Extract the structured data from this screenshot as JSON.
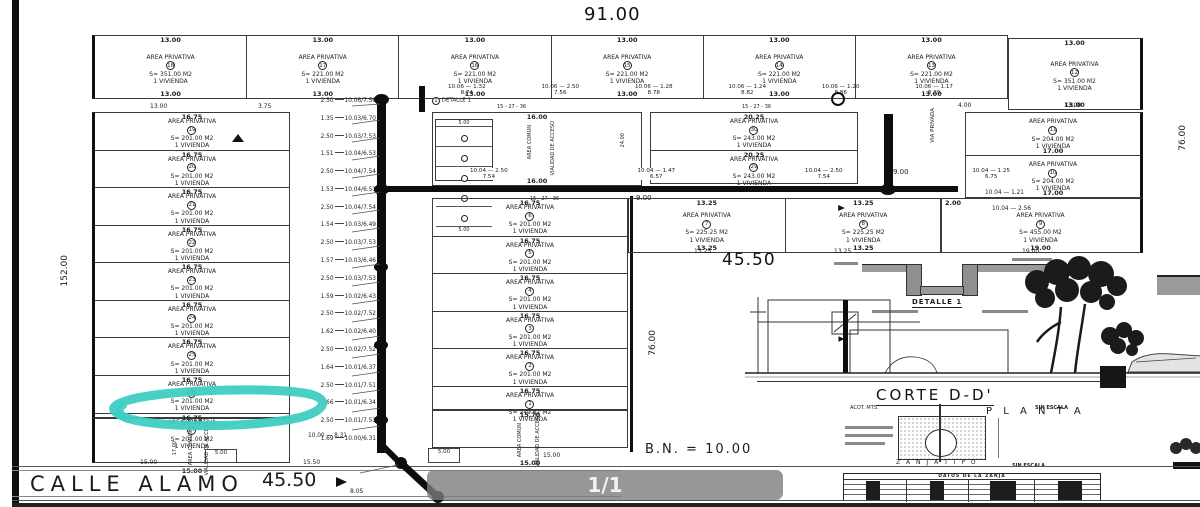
{
  "colors": {
    "highlight": "#3ECDC4",
    "ink": "#222222",
    "overlay_bg": "#7d7d7d"
  },
  "header": {
    "total_width": "91.00"
  },
  "side_dims": {
    "left_height": "152.00",
    "center_height": "76.00",
    "right_height": "76.00"
  },
  "lot_common": {
    "area_label": "AREA PRIVATIVA",
    "vivienda": "1 VIVIENDA"
  },
  "top_row": {
    "lots": [
      {
        "num": "18",
        "w": "13.00",
        "s": "S= 351.00 M2"
      },
      {
        "num": "17",
        "w": "13.00",
        "s": "S= 221.00 M2"
      },
      {
        "num": "16",
        "w": "13.00",
        "s": "S= 221.00 M2"
      },
      {
        "num": "15",
        "w": "13.00",
        "s": "S= 221.00 M2"
      },
      {
        "num": "14",
        "w": "13.00",
        "s": "S= 221.00 M2"
      },
      {
        "num": "13",
        "w": "13.00",
        "s": "S= 221.00 M2"
      }
    ],
    "corner": {
      "num": "12",
      "w": "13.00",
      "wb": "13.00",
      "s": "S= 351.00 M2"
    }
  },
  "left_col": {
    "sub_a": "13.00",
    "sub_b": "3.75",
    "lots": [
      {
        "num": "19",
        "w": "16.75",
        "s": "S= 201.00 M2"
      },
      {
        "num": "20",
        "w": "16.75",
        "s": "S= 201.00 M2"
      },
      {
        "num": "21",
        "w": "16.75",
        "s": "S= 201.00 M2"
      },
      {
        "num": "22",
        "w": "16.75",
        "s": "S= 201.00 M2"
      },
      {
        "num": "23",
        "w": "16.75",
        "s": "S= 201.00 M2"
      },
      {
        "num": "24",
        "w": "16.75",
        "s": "S= 201.00 M2"
      },
      {
        "num": "25",
        "w": "16.75",
        "s": "S= 201.00 M2"
      },
      {
        "num": "26",
        "w": "16.75",
        "s": "S= 201.00 M2"
      },
      {
        "num": "27",
        "w": "16.75",
        "s": "S= 201.00 M2"
      }
    ],
    "bottom_lot": {
      "w": "16.75",
      "wb": "15.00",
      "side": "17.00",
      "vtext": "VIALIDAD DE ACCESO",
      "vtext2": "AREA COMUN"
    }
  },
  "center_col": {
    "detail_lot": {
      "w": "16.00",
      "wb": "16.00",
      "cell_top": "5.00",
      "cell_bottom": "5.00",
      "side": "24.00",
      "vtext": "AREA COMUN",
      "vtext2": "VIALIDAD DE ACCESO"
    },
    "lots": [
      {
        "num": "6",
        "w": "16.75",
        "s": "S= 201.00 M2"
      },
      {
        "num": "5",
        "w": "16.75",
        "s": "S= 201.00 M2"
      },
      {
        "num": "4",
        "w": "16.75",
        "s": "S= 201.00 M2"
      },
      {
        "num": "3",
        "w": "16.75",
        "s": "S= 201.00 M2"
      },
      {
        "num": "2",
        "w": "16.75",
        "s": "S= 201.00 M2"
      },
      {
        "num": "1",
        "w": "16.75",
        "s": "S= 249.67 M2"
      }
    ],
    "bottom_lot": {
      "w": "15.70",
      "wb": "15.00",
      "vtext": "VIALIDAD DE ACCESO",
      "vtext2": "AREA COMUN"
    }
  },
  "pair_col": {
    "lots": [
      {
        "num": "30",
        "w": "20.25",
        "s": "S= 243.00 M2"
      },
      {
        "num": "29",
        "w": "20.25",
        "s": "S= 243.00 M2",
        "wb": "20.25"
      }
    ]
  },
  "row_13_25": {
    "lots": [
      {
        "num": "7",
        "w": "13.25",
        "wb": "13.25",
        "s": "S= 225.25 M2"
      },
      {
        "num": "8",
        "w": "13.25",
        "wb": "13.25",
        "s": "S= 225.25 M2"
      }
    ]
  },
  "right_col": {
    "lots": [
      {
        "num": "11",
        "wb": "17.00",
        "s": "S= 204.00 M2"
      },
      {
        "num": "10",
        "wb": "17.00",
        "s": "S= 204.00 M2"
      }
    ],
    "big_lot": {
      "num": "9",
      "wb": "19.00",
      "s": "S= 455.00 M2",
      "side": "2.00"
    },
    "via_privada": "VIA PRIVADA",
    "w4": "4.00",
    "w13": "13.00"
  },
  "leaders_left": [
    {
      "a": "2.50",
      "b": "10.06",
      "c": "7.56"
    },
    {
      "a": "1.35",
      "b": "10.03",
      "c": "6.70"
    },
    {
      "a": "2.50",
      "b": "10.03",
      "c": "7.53"
    },
    {
      "a": "1.51",
      "b": "10.04",
      "c": "6.53"
    },
    {
      "a": "2.50",
      "b": "10.04",
      "c": "7.54"
    },
    {
      "a": "1.53",
      "b": "10.04",
      "c": "6.51"
    },
    {
      "a": "2.50",
      "b": "10.04",
      "c": "7.54"
    },
    {
      "a": "1.54",
      "b": "10.03",
      "c": "6.49"
    },
    {
      "a": "2.50",
      "b": "10.03",
      "c": "7.53"
    },
    {
      "a": "1.57",
      "b": "10.03",
      "c": "6.46"
    },
    {
      "a": "2.50",
      "b": "10.03",
      "c": "7.53"
    },
    {
      "a": "1.59",
      "b": "10.02",
      "c": "6.43"
    },
    {
      "a": "2.50",
      "b": "10.02",
      "c": "7.52"
    },
    {
      "a": "1.62",
      "b": "10.02",
      "c": "6.40"
    },
    {
      "a": "2.50",
      "b": "10.02",
      "c": "7.52"
    },
    {
      "a": "1.64",
      "b": "10.01",
      "c": "6.37"
    },
    {
      "a": "2.50",
      "b": "10.01",
      "c": "7.51"
    },
    {
      "a": "1.66",
      "b": "10.01",
      "c": "6.34"
    },
    {
      "a": "2.50",
      "b": "10.01",
      "c": "7.51"
    },
    {
      "a": "1.69",
      "b": "10.00",
      "c": "6.31"
    }
  ],
  "leaders_top": [
    {
      "b": "10.06",
      "a": "1.32",
      "c": "8.74"
    },
    {
      "b": "10.06",
      "a": "2.50",
      "c": "7.56"
    },
    {
      "b": "10.06",
      "a": "1.28",
      "c": "8.78"
    },
    {
      "b": "10.06",
      "a": "1.24",
      "c": "8.82"
    },
    {
      "b": "10.06",
      "a": "1.20",
      "c": "8.86"
    },
    {
      "b": "10.06",
      "a": "1.17",
      "c": "8.89"
    }
  ],
  "leaders_mid": [
    {
      "b": "10.04",
      "a": "2.50",
      "c": "7.54"
    },
    {
      "b": "10.04",
      "a": "1.47",
      "c": "6.57"
    },
    {
      "b": "10.04",
      "a": "2.50",
      "c": "7.54"
    },
    {
      "b": "10.04",
      "a": "1.25",
      "c": "6.75"
    }
  ],
  "dims": {
    "n9a": "9.00",
    "n9b": "9.00",
    "mid4550": "45.50",
    "w1325a": "13.25",
    "w1325b": "13.25",
    "w1900": "19.00",
    "r1004a": "10.04 — 1.21",
    "r1004b": "10.04 — 2.56",
    "pipe1": "15 - 27 - 36",
    "pipe2": "15 - 27 - 36",
    "pipe3": "15 - 27 - 36",
    "b1500": "15.00",
    "b500": "5.00",
    "b1550": "15.50",
    "b1500c": "15.00",
    "b805": "8.05",
    "b1000": "10.00 — 8.31",
    "bn": "B.N.  = 10.00"
  },
  "street": {
    "name": "CALLE ALAMO",
    "dim": "45.50"
  },
  "details": {
    "detalle_ref": "DETALLE 1",
    "detalle1_label": "DETALLE 1",
    "corte_label": "CORTE  D-D'",
    "acot": "ACOT. MTS.",
    "escala": "SIN ESCALA",
    "planta": "P L A N T A",
    "zanja_label": "Z A N J A    T I P O",
    "zanja_escala": "SIN ESCALA",
    "table_title": "DATOS DE LA ZANJA"
  },
  "overlay": {
    "page_indicator": "1/1"
  }
}
